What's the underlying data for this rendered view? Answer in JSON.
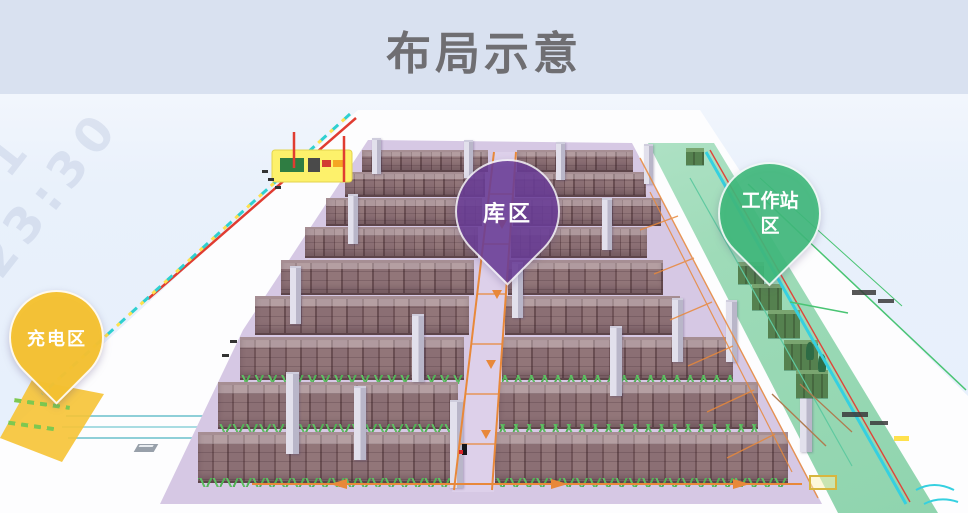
{
  "slide": {
    "title": "布局示意"
  },
  "watermark": {
    "text": "001 23:30"
  },
  "pins": {
    "storage": {
      "label": "库区"
    },
    "workstation": {
      "label": "工作站区"
    },
    "charging": {
      "label": "充电区"
    }
  },
  "colors": {
    "header_bg": "#d9e1f0",
    "title_text": "#6f6e72",
    "sky": "#e9f1fb",
    "ground": "#fdfdfe",
    "warehouse_floor": "#d6c8e4",
    "workstation_floor": "#9edbb8",
    "charging_floor": "#f6c335",
    "rack_face": "#7d6166",
    "pillar": "#b9b6c9",
    "path_orange": "#e8883a",
    "pin_storage": "#6b3d97",
    "pin_workstation": "#3fba7a",
    "pin_charging": "#f5c231"
  }
}
